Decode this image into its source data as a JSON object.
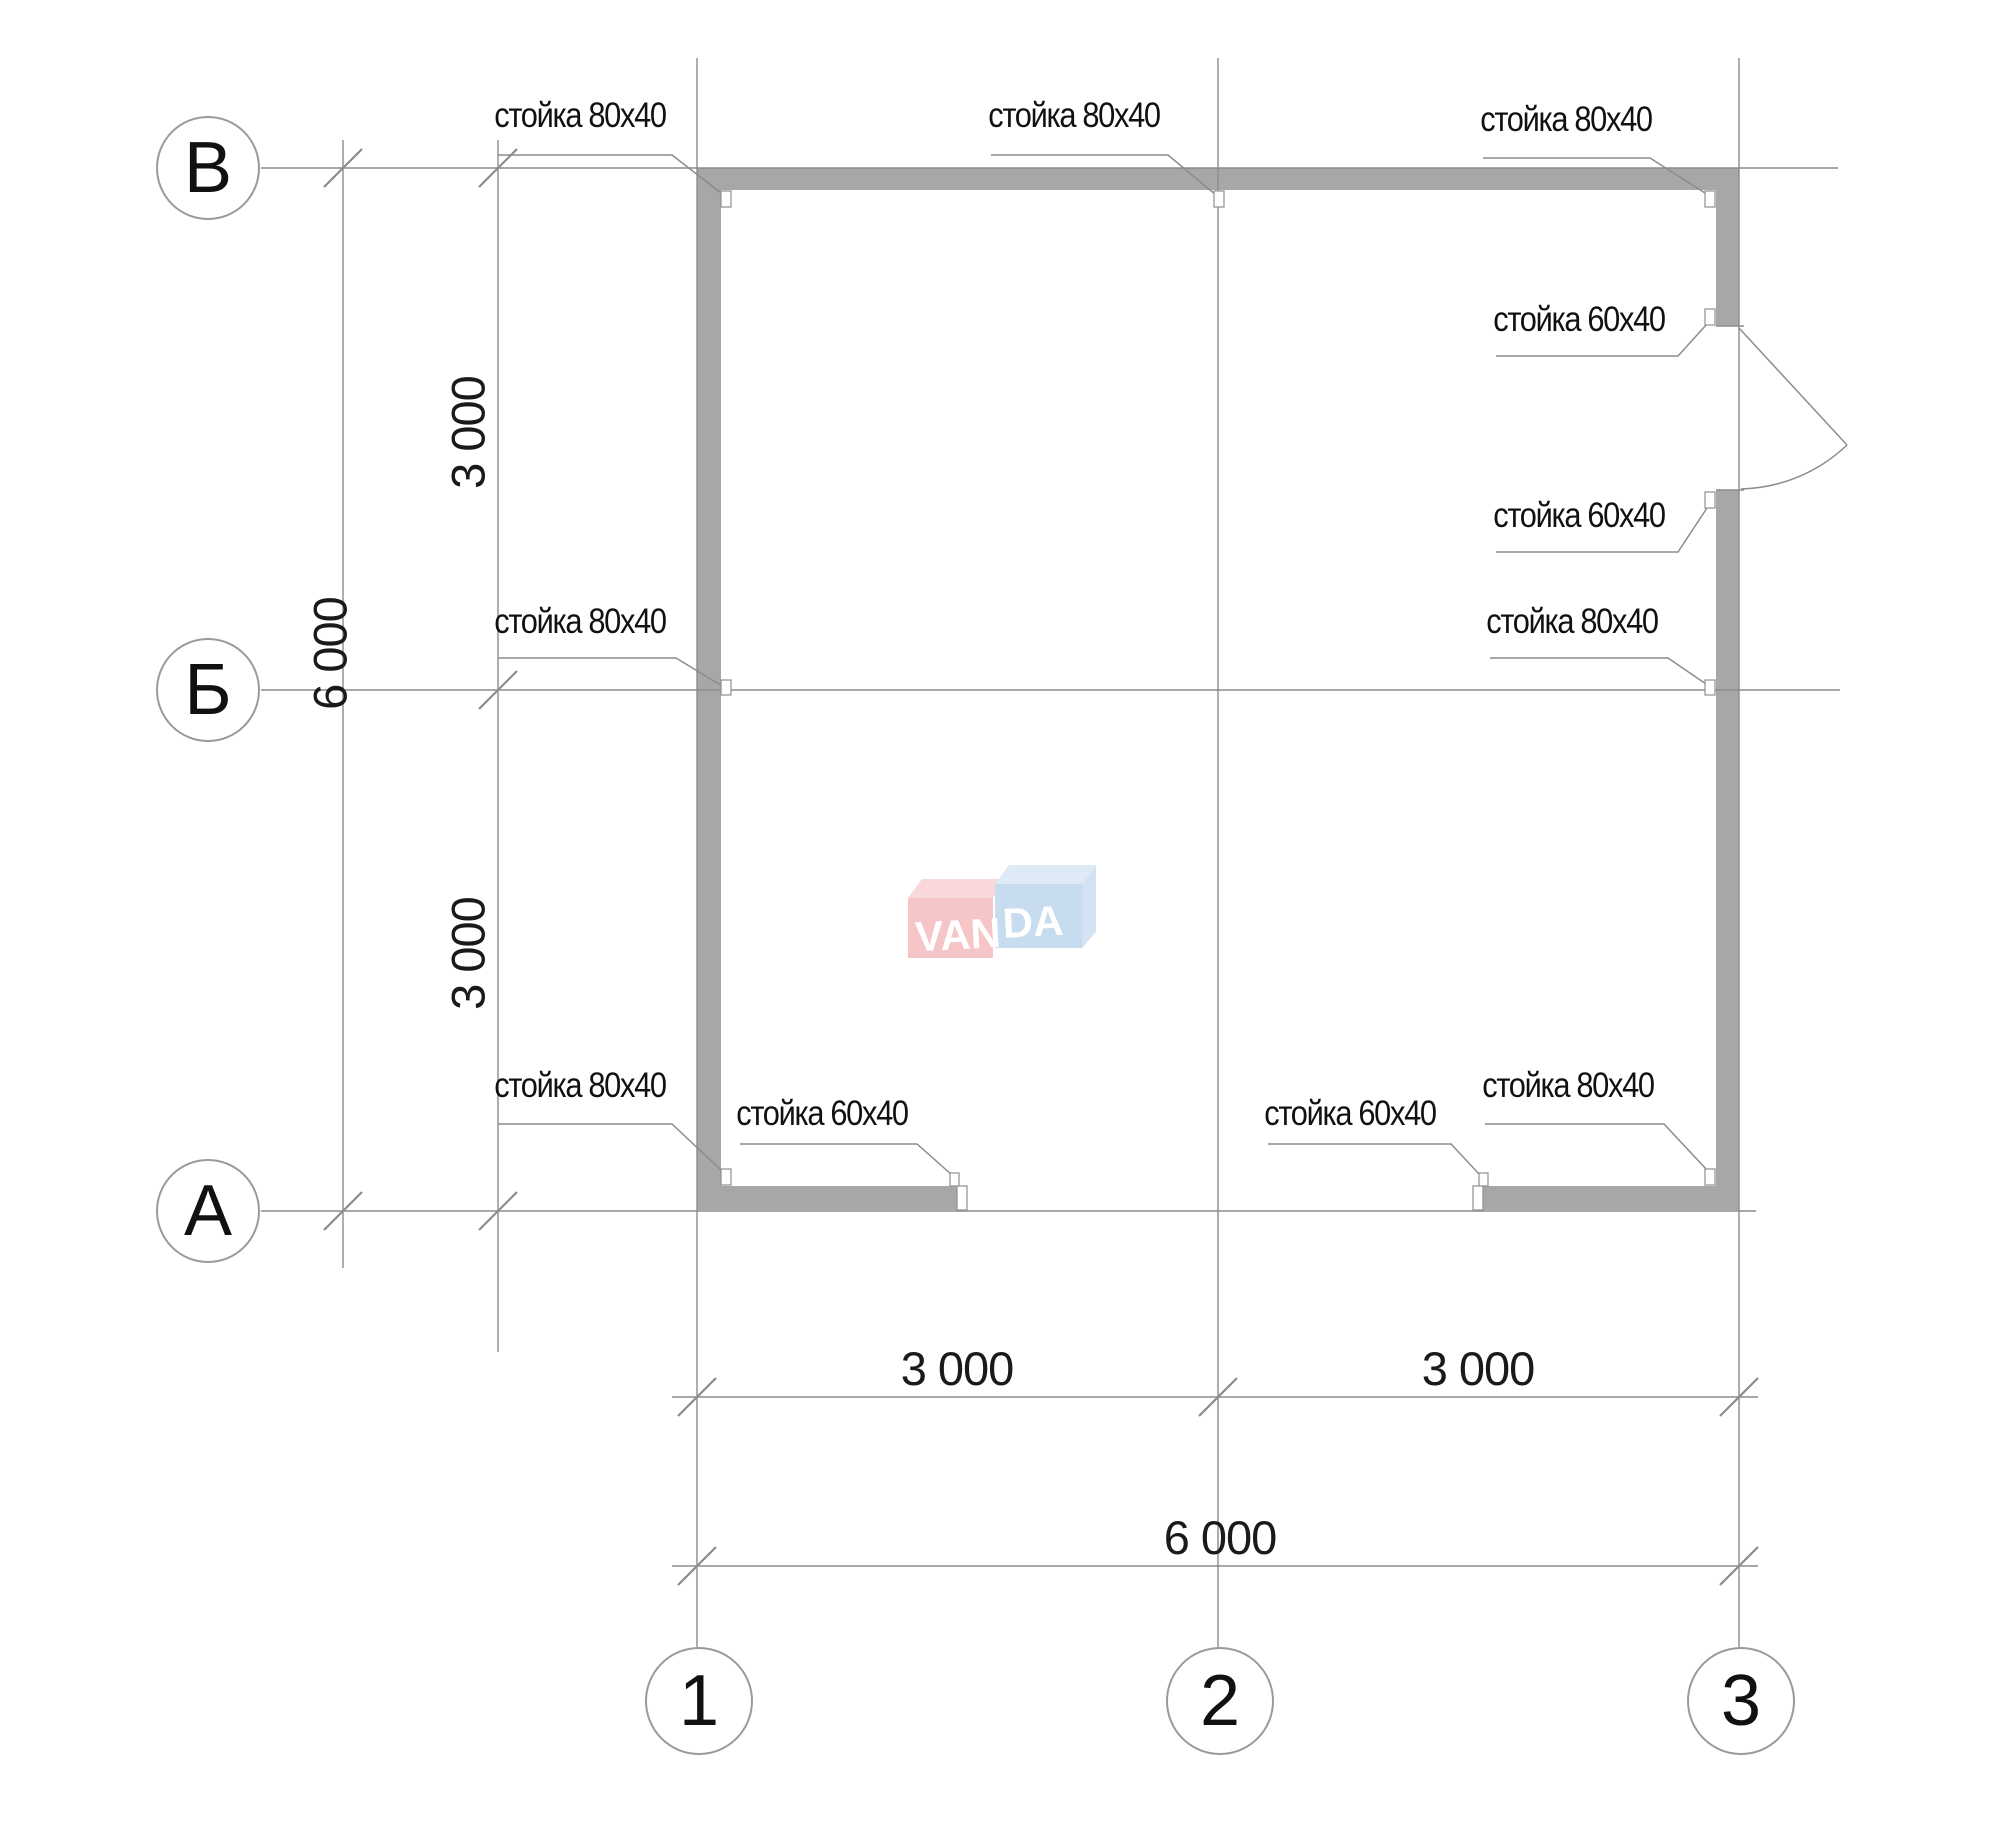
{
  "drawing": {
    "watermark": {
      "part1": "VAN",
      "part2": "DA"
    },
    "axis_rows": [
      {
        "label": "В"
      },
      {
        "label": "Б"
      },
      {
        "label": "А"
      }
    ],
    "axis_cols": [
      {
        "label": "1"
      },
      {
        "label": "2"
      },
      {
        "label": "3"
      }
    ],
    "dimensions": {
      "left_span_top": "3 000",
      "left_span_bottom": "3 000",
      "left_total": "6 000",
      "bottom_span_left": "3 000",
      "bottom_span_right": "3 000",
      "bottom_total": "6 000"
    },
    "post_labels": [
      {
        "id": "top-left",
        "text": "стойка 80х40"
      },
      {
        "id": "top-center",
        "text": "стойка 80х40"
      },
      {
        "id": "top-right",
        "text": "стойка 80х40"
      },
      {
        "id": "door-top",
        "text": "стойка 60х40"
      },
      {
        "id": "door-bottom",
        "text": "стойка 60х40"
      },
      {
        "id": "mid-left",
        "text": "стойка 80х40"
      },
      {
        "id": "mid-right",
        "text": "стойка 80х40"
      },
      {
        "id": "bottom-left-corner",
        "text": "стойка 80х40"
      },
      {
        "id": "bottom-left-inner",
        "text": "стойка 60х40"
      },
      {
        "id": "bottom-right-inner",
        "text": "стойка 60х40"
      },
      {
        "id": "bottom-right-corner",
        "text": "стойка 80х40"
      }
    ],
    "colors": {
      "wall": "#a7a7a7",
      "line": "#8c8c8c",
      "logo_pink": "#f5bfc3",
      "logo_pink_top": "#f8d4d6",
      "logo_blue": "#c3d9ef",
      "logo_blue_top": "#dbe9f7"
    }
  }
}
